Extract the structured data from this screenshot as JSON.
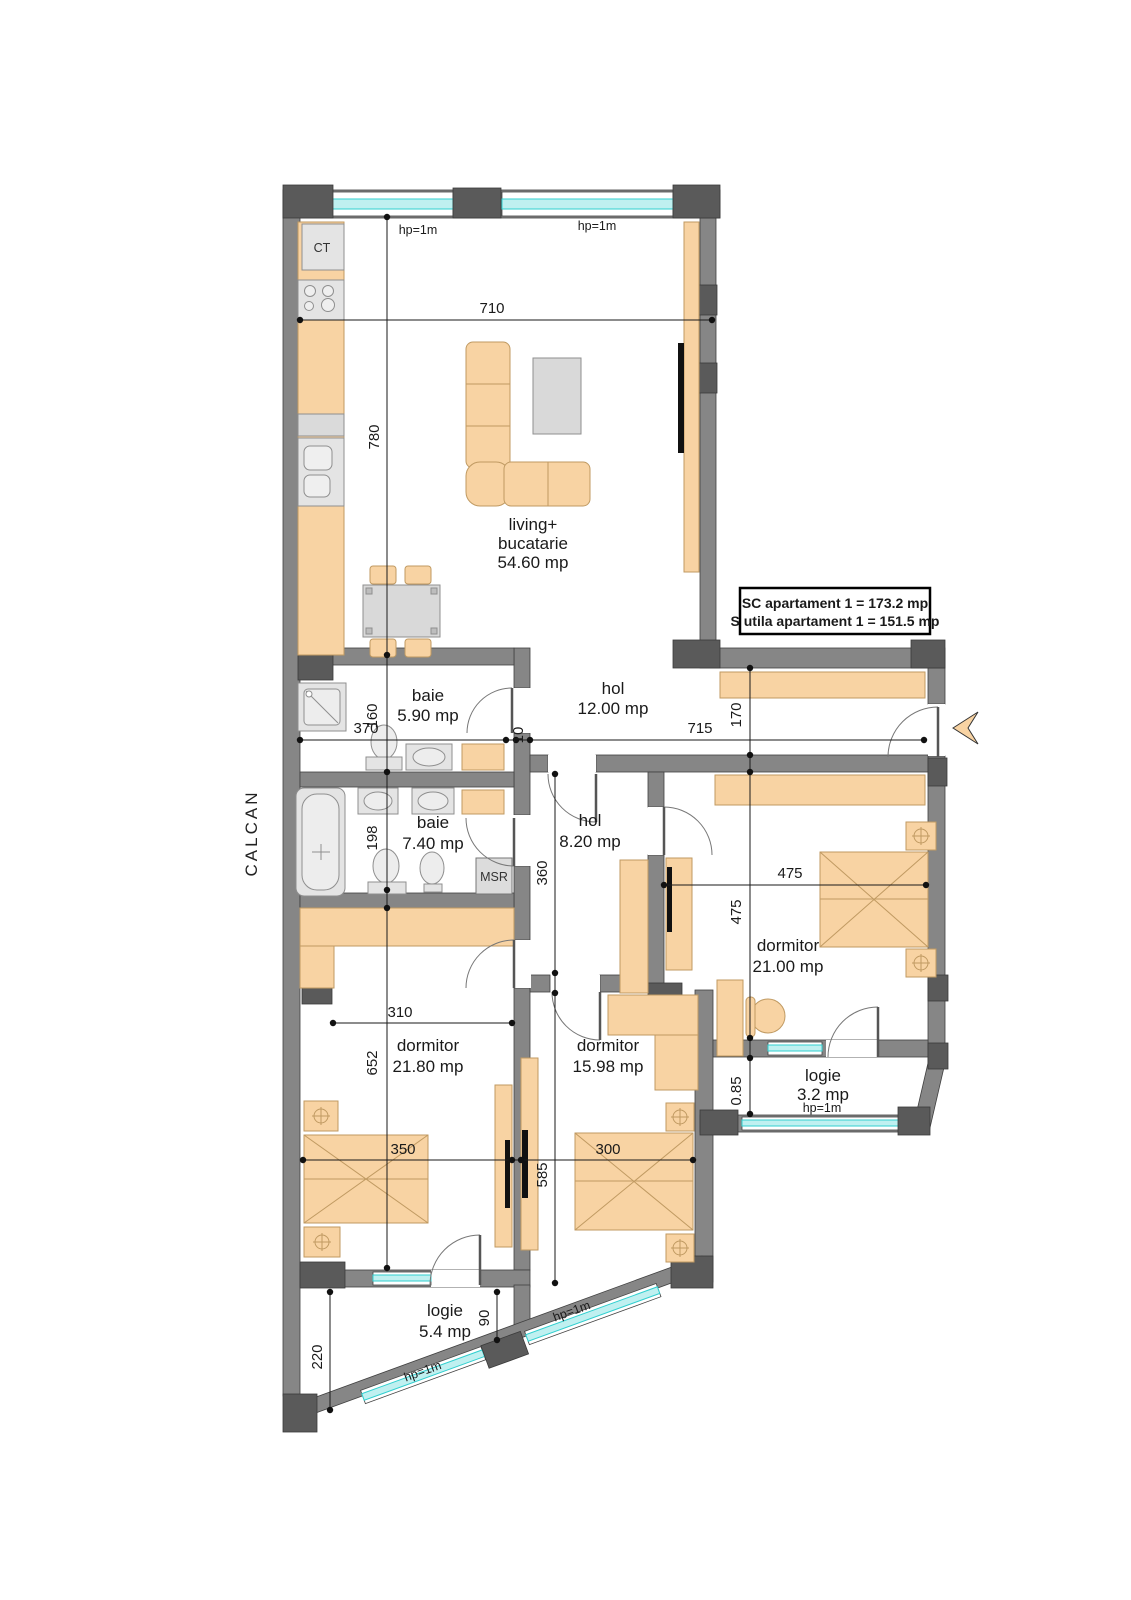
{
  "document_type": "apartment floor plan",
  "info_box": {
    "line1": "SC apartament 1 = 173.2 mp",
    "line2": "S utila apartament 1 = 151.5 mp"
  },
  "rooms": [
    {
      "name": "living+ bucatarie",
      "area": "54.60 mp"
    },
    {
      "name": "baie",
      "area": "5.90 mp"
    },
    {
      "name": "hol",
      "area": "12.00 mp"
    },
    {
      "name": "baie",
      "area": "7.40 mp"
    },
    {
      "name": "hol",
      "area": "8.20 mp"
    },
    {
      "name": "dormitor",
      "area": "21.00 mp"
    },
    {
      "name": "dormitor",
      "area": "21.80 mp"
    },
    {
      "name": "dormitor",
      "area": "15.98 mp"
    },
    {
      "name": "logie",
      "area": "3.2 mp"
    },
    {
      "name": "logie",
      "area": "5.4 mp"
    }
  ],
  "colors": {
    "wall": "#868686",
    "pillar": "#5a5a5a",
    "furniture": "#F8D3A3",
    "furniture_stroke": "#C09A62",
    "fixture": "#E4E4E4",
    "window_glass": "#BFF0F0",
    "window_line": "#30CFCF",
    "ink": "#1a1a1a"
  },
  "labels": [
    {
      "text": "living+",
      "x": 533,
      "y": 530,
      "rot": 0,
      "cls": "room",
      "name": "room-label-living"
    },
    {
      "text": "bucatarie",
      "x": 533,
      "y": 549,
      "rot": 0,
      "cls": "room",
      "name": "room-label-living"
    },
    {
      "text": "54.60 mp",
      "x": 533,
      "y": 568,
      "rot": 0,
      "cls": "room",
      "name": "room-area-living"
    },
    {
      "text": "baie",
      "x": 428,
      "y": 701,
      "rot": 0,
      "cls": "room",
      "name": "room-label-baie-1"
    },
    {
      "text": "5.90 mp",
      "x": 428,
      "y": 721,
      "rot": 0,
      "cls": "room",
      "name": "room-area-baie-1"
    },
    {
      "text": "hol",
      "x": 613,
      "y": 694,
      "rot": 0,
      "cls": "room",
      "name": "room-label-hol-1"
    },
    {
      "text": "12.00 mp",
      "x": 613,
      "y": 714,
      "rot": 0,
      "cls": "room",
      "name": "room-area-hol-1"
    },
    {
      "text": "baie",
      "x": 433,
      "y": 828,
      "rot": 0,
      "cls": "room",
      "name": "room-label-baie-2"
    },
    {
      "text": "7.40 mp",
      "x": 433,
      "y": 849,
      "rot": 0,
      "cls": "room",
      "name": "room-area-baie-2"
    },
    {
      "text": "hol",
      "x": 590,
      "y": 826,
      "rot": 0,
      "cls": "room",
      "name": "room-label-hol-2"
    },
    {
      "text": "8.20 mp",
      "x": 590,
      "y": 847,
      "rot": 0,
      "cls": "room",
      "name": "room-area-hol-2"
    },
    {
      "text": "dormitor",
      "x": 788,
      "y": 951,
      "rot": 0,
      "cls": "room",
      "name": "room-label-dormitor-1"
    },
    {
      "text": "21.00 mp",
      "x": 788,
      "y": 972,
      "rot": 0,
      "cls": "room",
      "name": "room-area-dormitor-1"
    },
    {
      "text": "dormitor",
      "x": 428,
      "y": 1051,
      "rot": 0,
      "cls": "room",
      "name": "room-label-dormitor-2"
    },
    {
      "text": "21.80 mp",
      "x": 428,
      "y": 1072,
      "rot": 0,
      "cls": "room",
      "name": "room-area-dormitor-2"
    },
    {
      "text": "dormitor",
      "x": 608,
      "y": 1051,
      "rot": 0,
      "cls": "room",
      "name": "room-label-dormitor-3"
    },
    {
      "text": "15.98 mp",
      "x": 608,
      "y": 1072,
      "rot": 0,
      "cls": "room",
      "name": "room-area-dormitor-3"
    },
    {
      "text": "logie",
      "x": 823,
      "y": 1081,
      "rot": 0,
      "cls": "room",
      "name": "room-label-logie-1"
    },
    {
      "text": "3.2 mp",
      "x": 823,
      "y": 1100,
      "rot": 0,
      "cls": "room",
      "name": "room-area-logie-1"
    },
    {
      "text": "logie",
      "x": 445,
      "y": 1316,
      "rot": 0,
      "cls": "room",
      "name": "room-label-logie-2"
    },
    {
      "text": "5.4 mp",
      "x": 445,
      "y": 1337,
      "rot": 0,
      "cls": "room",
      "name": "room-area-logie-2"
    },
    {
      "text": "710",
      "x": 492,
      "y": 313,
      "rot": 0,
      "cls": "dim",
      "name": "dim-710"
    },
    {
      "text": "780",
      "x": 379,
      "y": 437,
      "rot": -90,
      "cls": "dim",
      "name": "dim-780"
    },
    {
      "text": "370",
      "x": 366,
      "y": 733,
      "rot": 0,
      "cls": "dim",
      "name": "dim-370"
    },
    {
      "text": "10",
      "x": 523,
      "y": 735,
      "rot": -90,
      "cls": "dim",
      "name": "dim-10"
    },
    {
      "text": "715",
      "x": 700,
      "y": 733,
      "rot": 0,
      "cls": "dim",
      "name": "dim-715"
    },
    {
      "text": "160",
      "x": 377,
      "y": 716,
      "rot": -90,
      "cls": "dim",
      "name": "dim-160"
    },
    {
      "text": "198",
      "x": 377,
      "y": 838,
      "rot": -90,
      "cls": "dim",
      "name": "dim-198"
    },
    {
      "text": "652",
      "x": 377,
      "y": 1063,
      "rot": -90,
      "cls": "dim",
      "name": "dim-652"
    },
    {
      "text": "170",
      "x": 741,
      "y": 715,
      "rot": -90,
      "cls": "dim",
      "name": "dim-170"
    },
    {
      "text": "475",
      "x": 741,
      "y": 912,
      "rot": -90,
      "cls": "dim",
      "name": "dim-475-v"
    },
    {
      "text": "0.85",
      "x": 741,
      "y": 1091,
      "rot": -90,
      "cls": "dim",
      "name": "dim-085"
    },
    {
      "text": "475",
      "x": 790,
      "y": 878,
      "rot": 0,
      "cls": "dim",
      "name": "dim-475-h"
    },
    {
      "text": "360",
      "x": 547,
      "y": 873,
      "rot": -90,
      "cls": "dim",
      "name": "dim-360"
    },
    {
      "text": "585",
      "x": 547,
      "y": 1175,
      "rot": -90,
      "cls": "dim",
      "name": "dim-585"
    },
    {
      "text": "310",
      "x": 400,
      "y": 1017,
      "rot": 0,
      "cls": "dim",
      "name": "dim-310"
    },
    {
      "text": "350",
      "x": 403,
      "y": 1154,
      "rot": 0,
      "cls": "dim",
      "name": "dim-350"
    },
    {
      "text": "300",
      "x": 608,
      "y": 1154,
      "rot": 0,
      "cls": "dim",
      "name": "dim-300"
    },
    {
      "text": "90",
      "x": 489,
      "y": 1318,
      "rot": -90,
      "cls": "dim",
      "name": "dim-90"
    },
    {
      "text": "220",
      "x": 322,
      "y": 1357,
      "rot": -90,
      "cls": "dim",
      "name": "dim-220"
    },
    {
      "text": "hp=1m",
      "x": 418,
      "y": 234,
      "rot": 0,
      "cls": "hp",
      "name": "window-height-label"
    },
    {
      "text": "hp=1m",
      "x": 597,
      "y": 230,
      "rot": 0,
      "cls": "hp",
      "name": "window-height-label"
    },
    {
      "text": "hp=1m",
      "x": 822,
      "y": 1112,
      "rot": 0,
      "cls": "hp",
      "name": "window-height-label"
    },
    {
      "text": "hp=1m",
      "x": 424,
      "y": 1375,
      "rot": -20,
      "cls": "hp",
      "name": "window-height-label"
    },
    {
      "text": "hp=1m",
      "x": 573,
      "y": 1315,
      "rot": -20,
      "cls": "hp",
      "name": "window-height-label"
    },
    {
      "text": "CT",
      "x": 322,
      "y": 252,
      "rot": 0,
      "cls": "tag",
      "name": "boiler-label"
    },
    {
      "text": "MSR",
      "x": 494,
      "y": 881,
      "rot": 0,
      "cls": "tag",
      "name": "msr-label"
    },
    {
      "text": "CALCAN",
      "x": 257,
      "y": 833,
      "rot": -90,
      "cls": "side",
      "name": "calcan-label"
    },
    {
      "text": "SC apartament 1 = 173.2 mp",
      "x": 835,
      "y": 608,
      "rot": 0,
      "cls": "info",
      "name": "info-box-line1"
    },
    {
      "text": "S utila apartament 1 = 151.5 mp",
      "x": 835,
      "y": 626,
      "rot": 0,
      "cls": "info",
      "name": "info-box-line2"
    }
  ]
}
